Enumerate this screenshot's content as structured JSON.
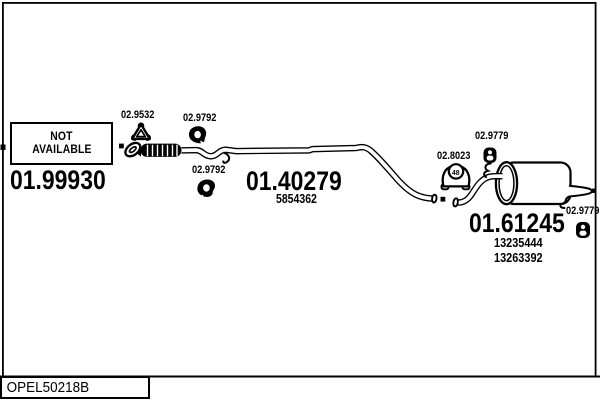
{
  "page": {
    "background": "#ffffff",
    "ink": "#000000",
    "footer_code": "OPEL50218B"
  },
  "not_available_box": {
    "line1": "NOT",
    "line2": "AVAILABLE",
    "part_code": "01.99930"
  },
  "center_pipe": {
    "part_code": "01.40279",
    "oe_number": "5854362"
  },
  "rear_muffler": {
    "part_code": "01.61245",
    "oe_number_1": "13235444",
    "oe_number_2": "13263392"
  },
  "fittings": {
    "gasket": {
      "code": "02.9532"
    },
    "mount_front_top": {
      "code": "02.9792"
    },
    "mount_front_bottom": {
      "code": "02.9792"
    },
    "bracket": {
      "code": "02.8023",
      "size_label": "48"
    },
    "grommet_top": {
      "code": "02.9779"
    },
    "grommet_rear": {
      "code": "02.9779"
    }
  }
}
